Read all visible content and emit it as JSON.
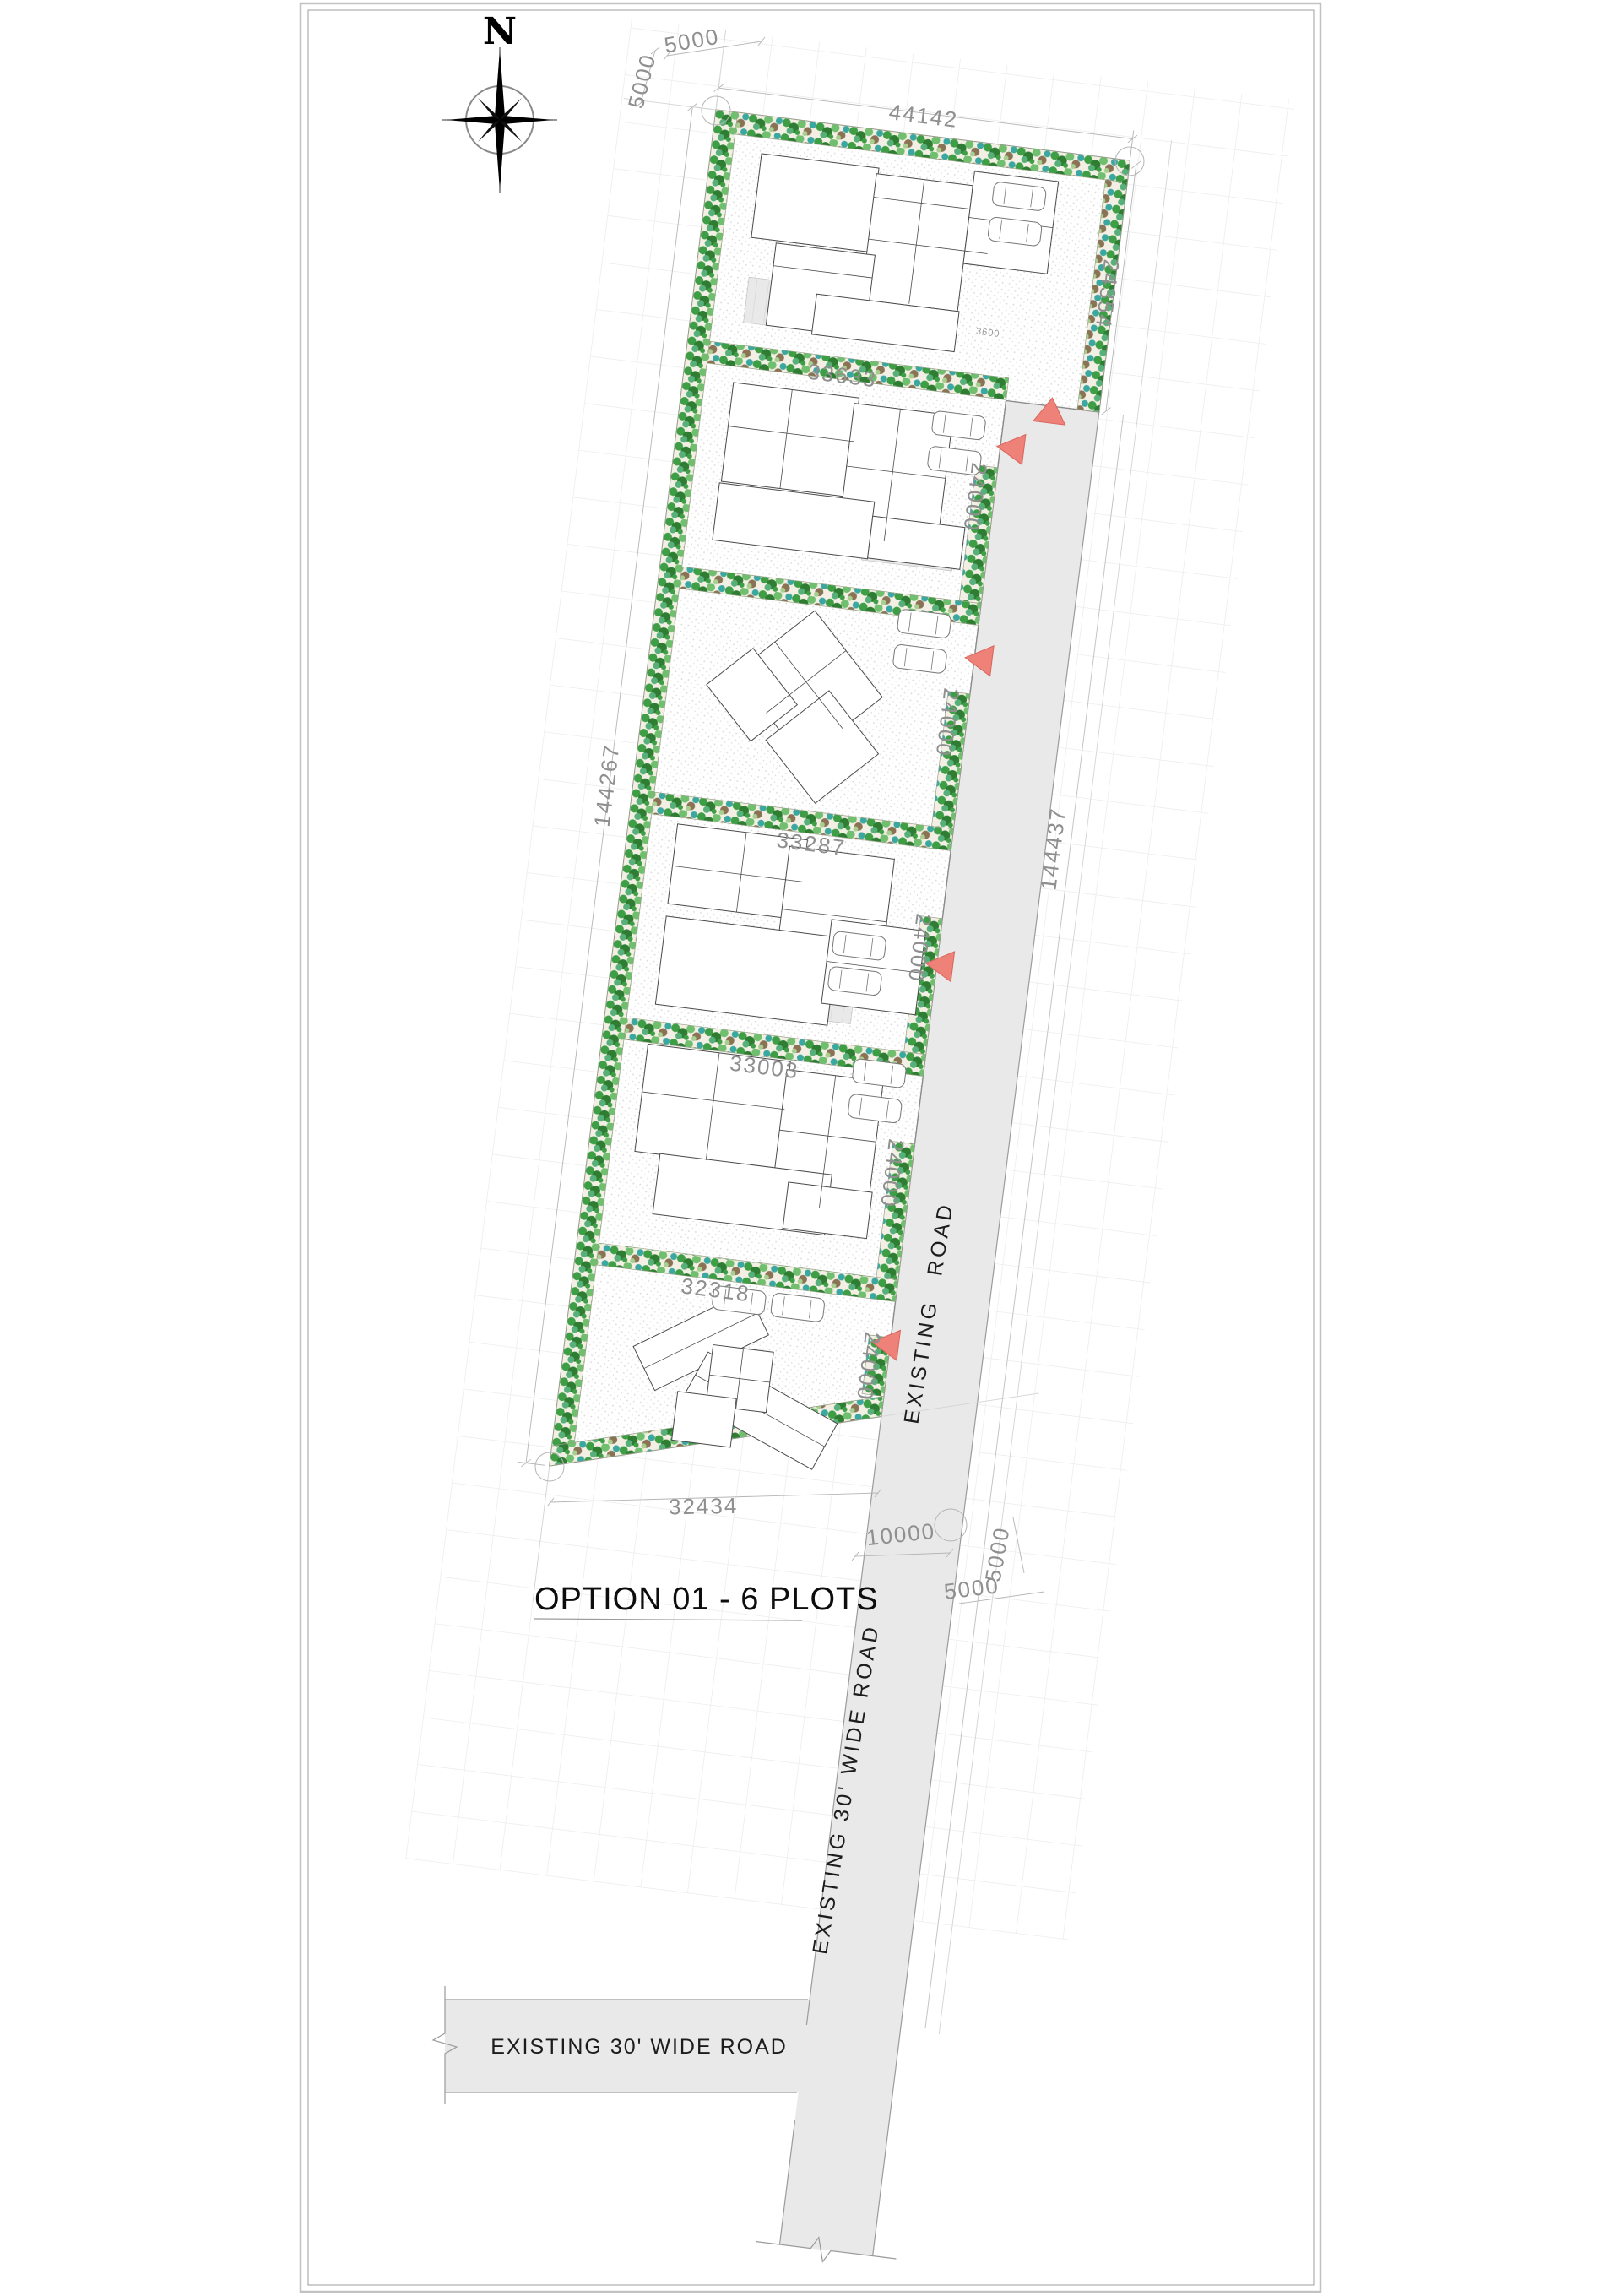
{
  "title": "OPTION 01 - 6 PLOTS",
  "north": {
    "label": "N"
  },
  "road_labels": {
    "site_road": "EXISTING ROAD",
    "south_road_vertical": "EXISTING 30' WIDE ROAD",
    "south_road_horizontal": "EXISTING 30' WIDE ROAD"
  },
  "dimensions": {
    "site_top_width": "44142",
    "plot1_depth": "24354",
    "west_boundary_length": "144267",
    "east_boundary_length": "144437",
    "plot_depth": "24000",
    "plot2_width": "33633",
    "plot4_width": "33287",
    "plot5_width": "33003",
    "plot6_width": "32318",
    "site_bottom_width": "32434",
    "access_road_width": "10000",
    "setback": "5000",
    "hedge_width": "3600"
  },
  "colors": {
    "road_fill": "#e9e9e9",
    "road_edge": "#9b9b9b",
    "arrow": "#ee8178",
    "arrow_edge": "#d9655c",
    "dim_text": "#8f8f8f",
    "grid": "#ededed",
    "hedge_bg": "#f3efe4",
    "hedge_palette": [
      "#3d9e46",
      "#2e7d32",
      "#6fbf6f",
      "#57b07a",
      "#8a7355",
      "#a8cf8f",
      "#3aa7a0"
    ],
    "lawn_dot": "#d8d8d8",
    "villa_line": "#4a4a4a",
    "deck_fill": "#e9e9e9",
    "boundary": "#8a8a8a"
  }
}
